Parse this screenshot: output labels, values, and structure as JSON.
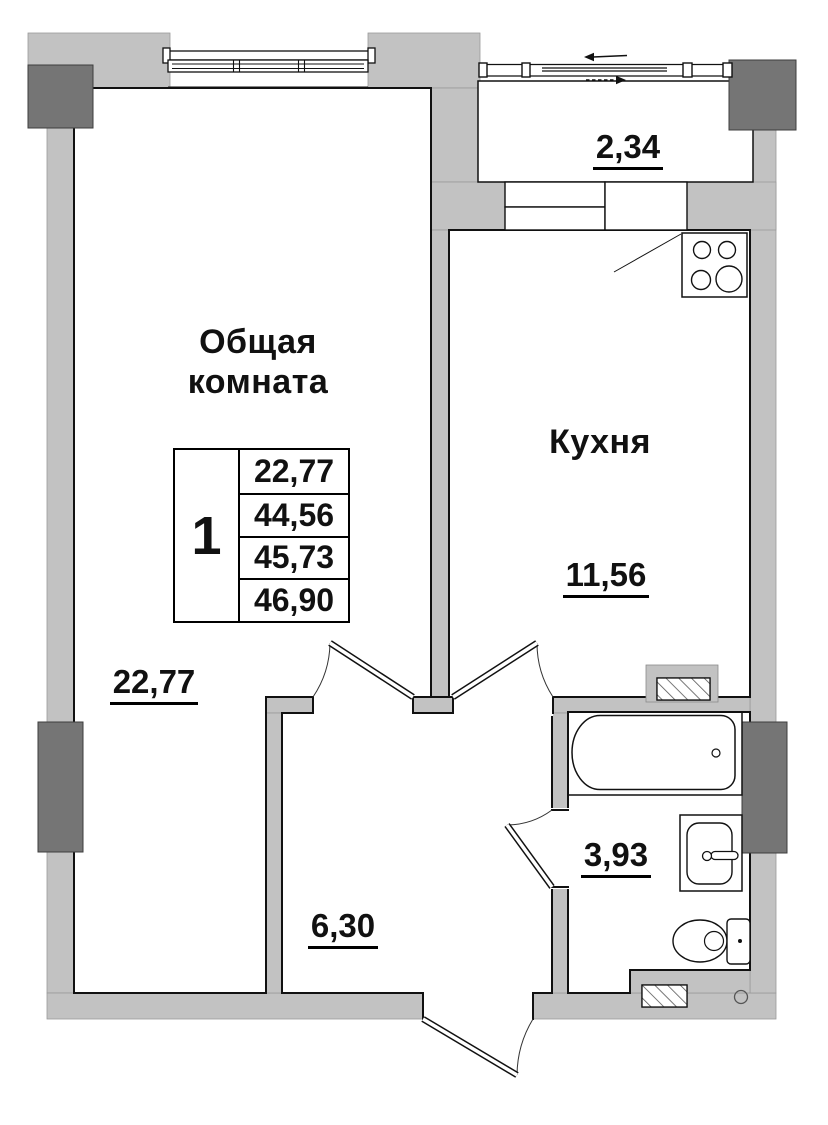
{
  "rooms": {
    "living_room": {
      "name_line1": "Общая",
      "name_line2": "комната",
      "area": "22,77"
    },
    "kitchen": {
      "name": "Кухня",
      "area": "11,56"
    },
    "balcony": {
      "area": "2,34"
    },
    "bathroom": {
      "area": "3,93"
    },
    "hallway": {
      "area": "6,30"
    }
  },
  "summary_table": {
    "rooms_count": "1",
    "rows": [
      {
        "value": "22,77"
      },
      {
        "value": "44,56"
      },
      {
        "value": "45,73"
      },
      {
        "value": "46,90"
      }
    ]
  },
  "colors": {
    "wall_fill": "#c2c2c2",
    "column_fill": "#757575",
    "line": "#111111",
    "background": "#ffffff"
  }
}
